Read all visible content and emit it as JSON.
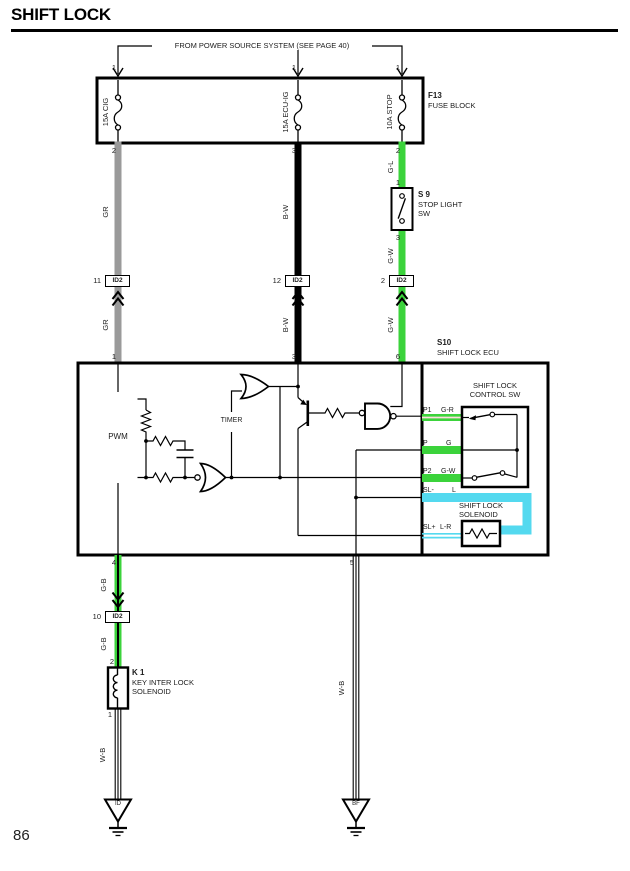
{
  "page": {
    "title": "SHIFT LOCK",
    "number": "86"
  },
  "power_note": "FROM POWER SOURCE SYSTEM (SEE PAGE 40)",
  "fuse_block": {
    "id": "F13",
    "name": "FUSE BLOCK",
    "fuses": [
      {
        "label": "15A CIG",
        "pin_in": "1",
        "pin_out": "2"
      },
      {
        "label": "15A ECU-IG",
        "pin_in": "1",
        "pin_out": "3"
      },
      {
        "label": "10A STOP",
        "pin_in": "1",
        "pin_out": "2"
      }
    ]
  },
  "stop_light_sw": {
    "id": "S 9",
    "line1": "STOP LIGHT",
    "line2": "SW",
    "pin_in": "1",
    "pin_out": "3"
  },
  "connector": {
    "label": "ID2",
    "instances": [
      "11",
      "12",
      "2",
      "10"
    ]
  },
  "ecu": {
    "id": "S10",
    "name": "SHIFT LOCK ECU",
    "pwm_label": "PWM",
    "timer_label": "TIMER",
    "pin_in": [
      "1",
      "3",
      "6"
    ],
    "pin_out": [
      "4",
      "5"
    ],
    "control_sw": {
      "line1": "SHIFT LOCK",
      "line2": "CONTROL SW"
    },
    "solenoid": {
      "line1": "SHIFT LOCK",
      "line2": "SOLENOID"
    },
    "terminals": [
      {
        "pin": "P1",
        "wire": "G-R"
      },
      {
        "pin": "P",
        "wire": "G"
      },
      {
        "pin": "P2",
        "wire": "G-W"
      },
      {
        "pin": "SL-",
        "wire": "L"
      },
      {
        "pin": "SL+",
        "wire": "L-R"
      }
    ]
  },
  "key_interlock_solenoid": {
    "id": "K 1",
    "line1": "KEY INTER LOCK",
    "line2": "SOLENOID",
    "pin_in": "2",
    "pin_out": "1"
  },
  "wire_labels": {
    "gr_upper": "GR",
    "bw_upper": "B-W",
    "gl": "G-L",
    "gw_upper": "G-W",
    "gr_lower": "GR",
    "bw_lower": "B-W",
    "gw_lower": "G-W",
    "gb_upper": "G-B",
    "gb_lower": "G-B",
    "wb_left": "W-B",
    "wb_right": "W-B"
  },
  "grounds": {
    "left": "ID",
    "right": "BF"
  },
  "colors": {
    "green": "#3bd33b",
    "cyan": "#54d9ef",
    "gray": "#9a9a9a",
    "wire_black": "#000000",
    "stripe_light": "#ffdddd"
  }
}
